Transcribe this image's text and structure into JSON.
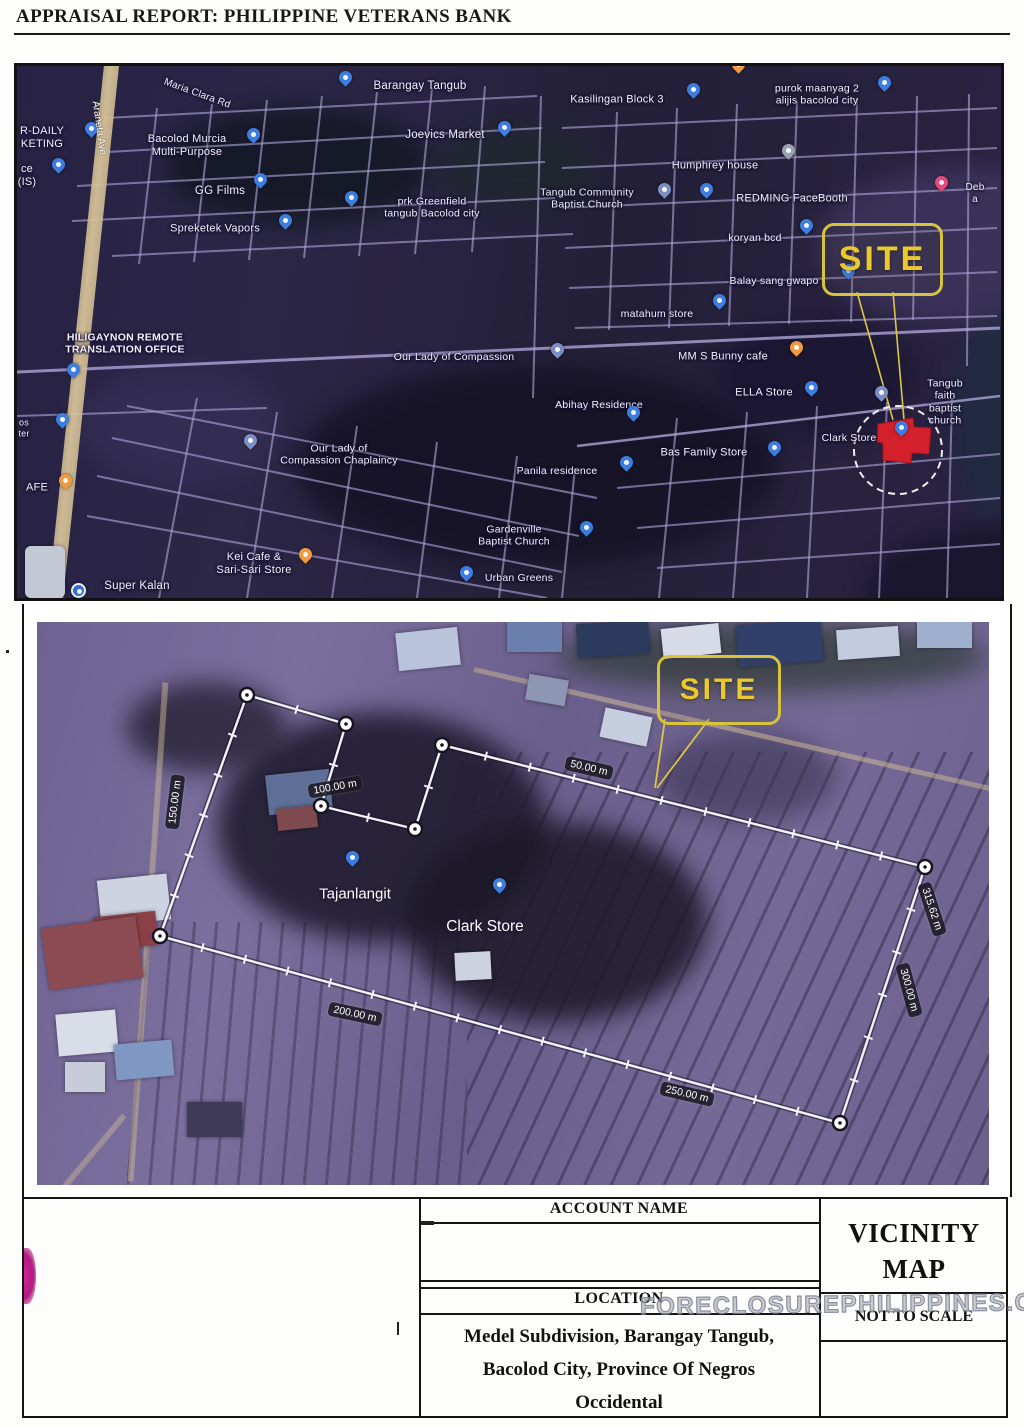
{
  "page": {
    "header_title": "APPRAISAL REPORT: PHILIPPINE VETERANS BANK"
  },
  "watermark": {
    "text": "FORECLOSUREPHILIPPINES.COM"
  },
  "map1": {
    "road_label": {
      "text": "Araneta Ave",
      "x": 82,
      "y": 62,
      "rot": 82
    },
    "site": {
      "label": "SITE",
      "box": [
        805,
        157,
        115,
        67
      ],
      "leaders": [
        [
          840,
          226,
          876,
          354
        ],
        [
          876,
          226,
          887,
          354
        ]
      ],
      "red_polygon": "861,358 896,352 897,361 914,362 912,388 895,387 894,397 866,394 866,377 860,376",
      "dash_circle": [
        881,
        384,
        44
      ]
    },
    "labels": [
      {
        "text": "Maria Clara Rd",
        "x": 180,
        "y": 28,
        "rot": 20,
        "size": 10
      },
      {
        "text": "Barangay Tangub",
        "x": 403,
        "y": 21,
        "size": 11.5
      },
      {
        "text": "Bacolod Murcia\nMulti-Purpose",
        "x": 170,
        "y": 80,
        "size": 11
      },
      {
        "text": "Joevics Market",
        "x": 428,
        "y": 70,
        "size": 11.5
      },
      {
        "text": "Kasilingan Block 3",
        "x": 600,
        "y": 34,
        "size": 11
      },
      {
        "text": "purok maanyag 2\nalijis bacolod city",
        "x": 800,
        "y": 29,
        "size": 10.5
      },
      {
        "text": "Humphrey house",
        "x": 698,
        "y": 100,
        "size": 11
      },
      {
        "text": "Tangub Community\nBaptist Church",
        "x": 570,
        "y": 133,
        "size": 10.5
      },
      {
        "text": "REDMING FaceBooth",
        "x": 775,
        "y": 133,
        "size": 11
      },
      {
        "text": "GG Films",
        "x": 203,
        "y": 126,
        "size": 11.5
      },
      {
        "text": "prk Greenfield\ntangub Bacolod city",
        "x": 415,
        "y": 142,
        "size": 10.5
      },
      {
        "text": "Spreketek Vapors",
        "x": 198,
        "y": 163,
        "size": 11
      },
      {
        "text": "koryan bcd",
        "x": 738,
        "y": 172,
        "size": 10.5
      },
      {
        "text": "Deb a",
        "x": 958,
        "y": 128,
        "size": 10
      },
      {
        "text": "Balay sang gwapo",
        "x": 757,
        "y": 215,
        "size": 10.5
      },
      {
        "text": "matahum store",
        "x": 640,
        "y": 248,
        "size": 10.5
      },
      {
        "text": "HILIGAYNON REMOTE\nTRANSLATION OFFICE",
        "x": 108,
        "y": 278,
        "size": 10.5,
        "bold": true
      },
      {
        "text": "Our Lady of Compassion",
        "x": 437,
        "y": 291,
        "size": 10.5
      },
      {
        "text": "MM S Bunny cafe",
        "x": 706,
        "y": 291,
        "size": 11
      },
      {
        "text": "ELLA Store",
        "x": 747,
        "y": 327,
        "size": 11
      },
      {
        "text": "Tangub faith\nbaptist church",
        "x": 928,
        "y": 336,
        "size": 10.5
      },
      {
        "text": "Abihay Residence",
        "x": 582,
        "y": 339,
        "size": 10.5
      },
      {
        "text": "Clark Store",
        "x": 832,
        "y": 372,
        "size": 10.5
      },
      {
        "text": "Our Lady of\nCompassion Chaplaincy",
        "x": 322,
        "y": 389,
        "size": 10.5
      },
      {
        "text": "Bas Family Store",
        "x": 687,
        "y": 387,
        "size": 11
      },
      {
        "text": "Panila residence",
        "x": 540,
        "y": 405,
        "size": 10.5
      },
      {
        "text": "Gardenville\nBaptist Church",
        "x": 497,
        "y": 470,
        "size": 10.5
      },
      {
        "text": "Kei Cafe &\nSari-Sari Store",
        "x": 237,
        "y": 498,
        "size": 11
      },
      {
        "text": "Urban Greens",
        "x": 502,
        "y": 512,
        "size": 10.5
      },
      {
        "text": "Super Kalan",
        "x": 120,
        "y": 521,
        "size": 11.5
      },
      {
        "text": "R-DAILY\nKETING",
        "x": 25,
        "y": 72,
        "size": 11
      },
      {
        "text": "ce\n(IS)",
        "x": 10,
        "y": 110,
        "size": 11
      },
      {
        "text": "AFE",
        "x": 20,
        "y": 422,
        "size": 11
      },
      {
        "text": "os\nter",
        "x": 7,
        "y": 362,
        "size": 9
      }
    ],
    "pins": [
      {
        "x": 328,
        "y": 21,
        "c": "blue"
      },
      {
        "x": 487,
        "y": 71,
        "c": "blue"
      },
      {
        "x": 74,
        "y": 72,
        "c": "blue"
      },
      {
        "x": 41,
        "y": 108,
        "c": "blue"
      },
      {
        "x": 236,
        "y": 78,
        "c": "blue"
      },
      {
        "x": 243,
        "y": 123,
        "c": "blue"
      },
      {
        "x": 334,
        "y": 141,
        "c": "blue"
      },
      {
        "x": 268,
        "y": 164,
        "c": "blue"
      },
      {
        "x": 676,
        "y": 33,
        "c": "blue"
      },
      {
        "x": 867,
        "y": 26,
        "c": "blue"
      },
      {
        "x": 771,
        "y": 94,
        "c": "gray"
      },
      {
        "x": 647,
        "y": 133,
        "c": "church"
      },
      {
        "x": 689,
        "y": 133,
        "c": "blue"
      },
      {
        "x": 721,
        "y": 8,
        "c": "orange"
      },
      {
        "x": 924,
        "y": 126,
        "c": "pink"
      },
      {
        "x": 789,
        "y": 169,
        "c": "blue"
      },
      {
        "x": 831,
        "y": 214,
        "c": "blue"
      },
      {
        "x": 702,
        "y": 244,
        "c": "blue"
      },
      {
        "x": 56,
        "y": 313,
        "c": "blue"
      },
      {
        "x": 45,
        "y": 363,
        "c": "blue"
      },
      {
        "x": 48,
        "y": 424,
        "c": "orange"
      },
      {
        "x": 540,
        "y": 293,
        "c": "church"
      },
      {
        "x": 779,
        "y": 291,
        "c": "orange"
      },
      {
        "x": 794,
        "y": 331,
        "c": "blue"
      },
      {
        "x": 864,
        "y": 336,
        "c": "church"
      },
      {
        "x": 616,
        "y": 356,
        "c": "blue"
      },
      {
        "x": 233,
        "y": 384,
        "c": "church"
      },
      {
        "x": 757,
        "y": 391,
        "c": "blue"
      },
      {
        "x": 609,
        "y": 406,
        "c": "blue"
      },
      {
        "x": 569,
        "y": 471,
        "c": "blue"
      },
      {
        "x": 288,
        "y": 498,
        "c": "orange"
      },
      {
        "x": 60,
        "y": 523,
        "c": "bluecircle"
      },
      {
        "x": 449,
        "y": 516,
        "c": "blue"
      },
      {
        "x": 884,
        "y": 371,
        "c": "blue"
      }
    ]
  },
  "map2": {
    "site": {
      "label": "SITE",
      "box": [
        620,
        33,
        118,
        64
      ],
      "leaders": [
        [
          628,
          97,
          618,
          166
        ],
        [
          672,
          97,
          620,
          166
        ]
      ]
    },
    "polygon": {
      "vertices": [
        [
          123,
          314
        ],
        [
          210,
          73
        ],
        [
          309,
          102
        ],
        [
          284,
          184
        ],
        [
          378,
          207
        ],
        [
          405,
          123
        ],
        [
          888,
          245
        ],
        [
          803,
          501
        ]
      ]
    },
    "measurements": [
      {
        "text": "150.00 m",
        "x": 138,
        "y": 180,
        "rot": -83
      },
      {
        "text": "100.00 m",
        "x": 298,
        "y": 165,
        "rot": -10
      },
      {
        "text": "50.00 m",
        "x": 552,
        "y": 146,
        "rot": 13
      },
      {
        "text": "315.62 m",
        "x": 895,
        "y": 287,
        "rot": 72
      },
      {
        "text": "300.00 m",
        "x": 872,
        "y": 368,
        "rot": 75
      },
      {
        "text": "250.00 m",
        "x": 650,
        "y": 472,
        "rot": 13
      },
      {
        "text": "200.00 m",
        "x": 318,
        "y": 392,
        "rot": 12
      }
    ],
    "pins": [
      {
        "label": "Tajanlangit",
        "x": 315,
        "y": 245,
        "lx": 318,
        "ly": 272,
        "lsize": 15
      },
      {
        "label": "Clark Store",
        "x": 462,
        "y": 272,
        "lx": 448,
        "ly": 305,
        "lsize": 15.5
      }
    ]
  },
  "table": {
    "account_name_label": "ACCOUNT NAME",
    "account_name_value": "",
    "location_label": "LOCATION",
    "location_lines": [
      "Medel  Subdivision, Barangay Tangub,",
      "Bacolod City, Province Of Negros",
      "Occidental"
    ],
    "vicinity_title": "VICINITY MAP",
    "scale_note": "NOT TO SCALE"
  }
}
